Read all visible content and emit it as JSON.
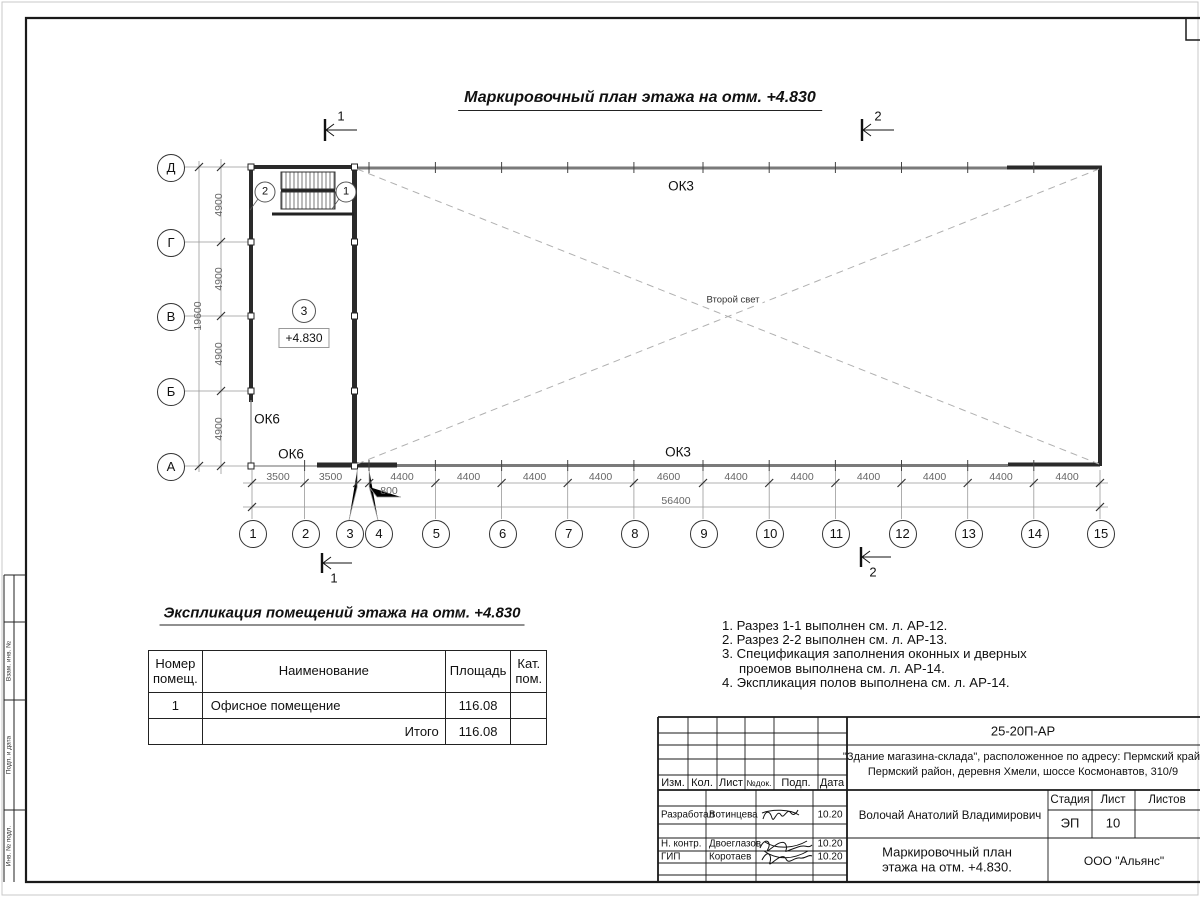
{
  "page_title": "Маркировочный план этажа на отм. +4.830",
  "plan": {
    "row_axes": [
      "Д",
      "Г",
      "В",
      "Б",
      "А"
    ],
    "col_axes": [
      "1",
      "2",
      "3",
      "4",
      "5",
      "6",
      "7",
      "8",
      "9",
      "10",
      "11",
      "12",
      "13",
      "14",
      "15"
    ],
    "v_dims": [
      "4900",
      "4900",
      "4900",
      "4900"
    ],
    "v_total": "19600",
    "h_dims": [
      "3500",
      "3500",
      "4400",
      "4400",
      "4400",
      "4400",
      "4600",
      "4400",
      "4400",
      "4400",
      "4400",
      "4400",
      "4400"
    ],
    "h_dim_offset": "800",
    "h_total": "56400",
    "window_top": "ОК3",
    "window_bottom": "ОК3",
    "window_left": "ОК6",
    "window_sill": "ОК6",
    "second_light": "Второй свет",
    "room_tag": "3",
    "level_mark": "+4.830",
    "door_tag_left": "2",
    "door_tag_right": "1",
    "section1": "1",
    "section2": "2"
  },
  "explication": {
    "heading": "Экспликация помещений этажа на отм. +4.830",
    "col_num": "Номер\nпомещ.",
    "col_name": "Наименование",
    "col_area": "Площадь",
    "col_cat": "Кат.\nпом.",
    "row_num": "1",
    "row_name": "Офисное помещение",
    "row_area": "116.08",
    "total_label": "Итого",
    "total_area": "116.08"
  },
  "notes": [
    "1. Разрез 1-1 выполнен см. л. АР-12.",
    "2. Разрез 2-2 выполнен см. л. АР-13.",
    "3. Спецификация заполнения оконных и дверных\nпроемов выполнена см. л. АР-14.",
    "4. Экспликация полов выполнена см. л. АР-14."
  ],
  "titleblock": {
    "doc_number": "25-20П-АР",
    "project_line1": "\"Здание магазина-склада\", расположенное по адресу: Пермский край,",
    "project_line2": "Пермский район, деревня Хмели, шоссе Космонавтов, 310/9",
    "h_izm": "Изм.",
    "h_kol": "Кол.",
    "h_list": "Лист",
    "h_doc": "№док.",
    "h_podp": "Подп.",
    "h_data": "Дата",
    "row1_role": "Разработал",
    "row1_name": "Вотинцева",
    "row1_date": "10.20",
    "row2_role": "Н. контр.",
    "row2_name": "Двоеглазов",
    "row2_date": "10.20",
    "row3_role": "ГИП",
    "row3_name": "Коротаев",
    "row3_date": "10.20",
    "approver": "Волочай Анатолий Владимирович",
    "stage_label": "Стадия",
    "sheet_label": "Лист",
    "sheets_label": "Листов",
    "stage": "ЭП",
    "sheet_no": "10",
    "drawing_title_line1": "Маркировочный план",
    "drawing_title_line2": "этажа на отм. +4.830.",
    "company": "ООО \"Альянс\""
  },
  "margin_labels": [
    "Взам. инв. №",
    "Подп. и дата",
    "Инв. № подл."
  ]
}
